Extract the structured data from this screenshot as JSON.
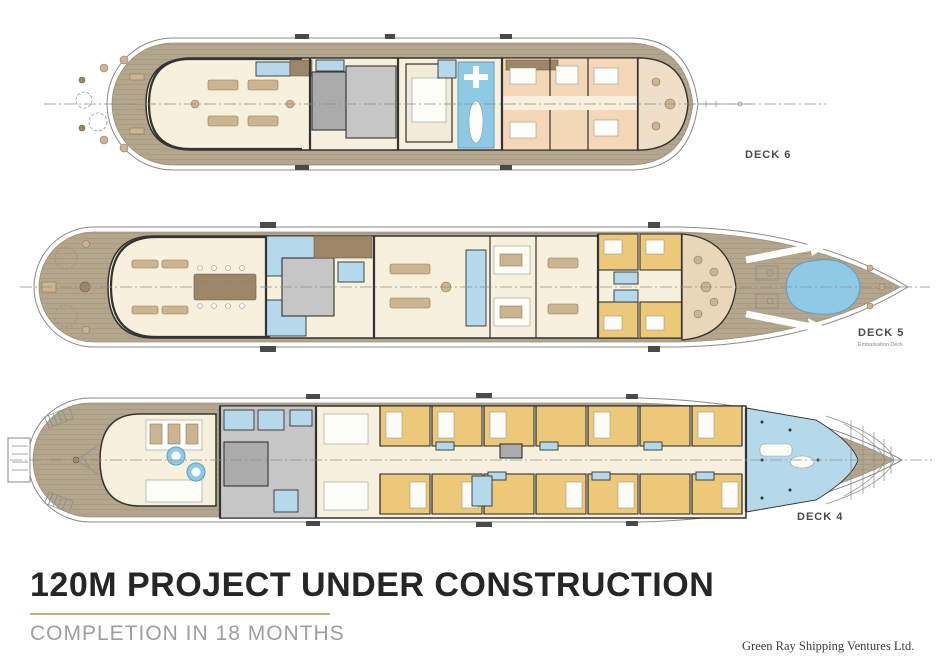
{
  "document": {
    "background": "#ffffff",
    "type": "yacht-deck-plans"
  },
  "decks": [
    {
      "id": "deck-6",
      "label": "DECK 6"
    },
    {
      "id": "deck-5",
      "label": "DECK 5",
      "sublabel": "Embarkation Deck"
    },
    {
      "id": "deck-4",
      "label": "DECK 4"
    }
  ],
  "title_block": {
    "title": "120M PROJECT UNDER CONSTRUCTION",
    "subtitle": "COMPLETION IN 18 MONTHS",
    "credit": "Green Ray Shipping Ventures Ltd."
  },
  "palette": {
    "teak_deck": "#b4a58d",
    "interior_cream": "#f6f0dc",
    "cabin_peach": "#f3d7b6",
    "cabin_gold": "#ecc878",
    "water_blue": "#8ec9e6",
    "wet_area_blue": "#b5d8ea",
    "technical_gray": "#ababab",
    "wall_dark": "#333333",
    "hull_line": "#8a8a8a",
    "accent_gold": "#bfae82",
    "title_ink": "#262626",
    "subtitle_gray": "#9e9e9e"
  }
}
